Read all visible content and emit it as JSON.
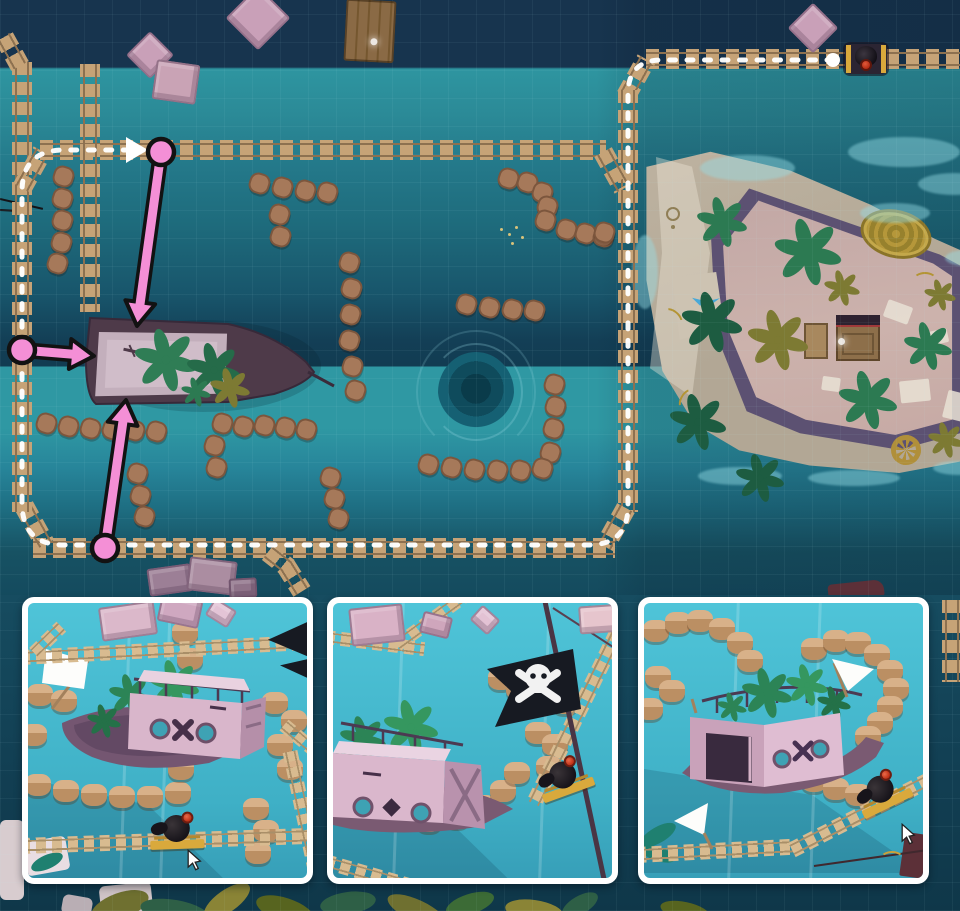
{
  "palette": {
    "backdrop": "#123f53",
    "waterLight": "#2f98a3",
    "stone": "#a6795a",
    "tieTan": "#c6a377",
    "railBrown": "#8d7150",
    "tieLight": "#d8bb90",
    "railLight": "#a98f68",
    "pillarTop": "#d8b189",
    "pillarSide": "#bb8f63",
    "insetWater1": "#4fc4d8",
    "insetWater2": "#3fb0c6",
    "cartGold": "#d9a93c",
    "pinkArrow": "#f48fd6",
    "arrowOutline": "#121212",
    "routeWhite": "#ffffff",
    "flagBlack": "#171a22",
    "shipHull": "#4e3a49",
    "insetHull": "#7a5a72",
    "porthole": "#3ea2b4"
  },
  "map": {
    "stone_dots": [
      [
        63,
        176
      ],
      [
        62,
        198
      ],
      [
        62,
        220
      ],
      [
        61,
        242
      ],
      [
        57,
        263
      ],
      [
        46,
        423
      ],
      [
        68,
        426
      ],
      [
        90,
        428
      ],
      [
        112,
        429
      ],
      [
        134,
        430
      ],
      [
        156,
        431
      ],
      [
        222,
        423
      ],
      [
        243,
        426
      ],
      [
        264,
        425
      ],
      [
        285,
        427
      ],
      [
        306,
        429
      ],
      [
        214,
        445
      ],
      [
        216,
        467
      ],
      [
        137,
        473
      ],
      [
        140,
        495
      ],
      [
        144,
        516
      ],
      [
        330,
        477
      ],
      [
        334,
        498
      ],
      [
        338,
        518
      ],
      [
        349,
        262
      ],
      [
        351,
        288
      ],
      [
        350,
        314
      ],
      [
        349,
        340
      ],
      [
        352,
        366
      ],
      [
        355,
        390
      ],
      [
        259,
        183
      ],
      [
        282,
        187
      ],
      [
        305,
        190
      ],
      [
        327,
        192
      ],
      [
        279,
        214
      ],
      [
        280,
        236
      ],
      [
        508,
        178
      ],
      [
        527,
        182
      ],
      [
        542,
        192
      ],
      [
        547,
        206
      ],
      [
        545,
        220
      ],
      [
        566,
        229
      ],
      [
        585,
        233
      ],
      [
        603,
        236
      ],
      [
        466,
        304
      ],
      [
        489,
        307
      ],
      [
        512,
        309
      ],
      [
        534,
        310
      ],
      [
        554,
        384
      ],
      [
        555,
        406
      ],
      [
        553,
        428
      ],
      [
        550,
        452
      ],
      [
        542,
        468
      ],
      [
        520,
        470
      ],
      [
        497,
        470
      ],
      [
        474,
        469
      ],
      [
        451,
        467
      ],
      [
        428,
        464
      ],
      [
        259,
        346
      ],
      [
        281,
        355
      ],
      [
        604,
        232
      ]
    ],
    "tracks": [
      {
        "x": 646,
        "y": 59,
        "len": 314,
        "a": 0
      },
      {
        "x": 626,
        "y": 96,
        "len": 42,
        "a": -61
      },
      {
        "x": 628,
        "y": 90,
        "len": 422,
        "a": 90
      },
      {
        "x": 626,
        "y": 508,
        "len": 44,
        "a": 119
      },
      {
        "x": 33,
        "y": 548,
        "len": 582,
        "a": 0
      },
      {
        "x": 24,
        "y": 506,
        "len": 44,
        "a": 61
      },
      {
        "x": 22,
        "y": 62,
        "len": 450,
        "a": 90
      },
      {
        "x": 22,
        "y": 188,
        "len": 42,
        "a": -61
      },
      {
        "x": 40,
        "y": 150,
        "len": 566,
        "a": 0
      },
      {
        "x": 603,
        "y": 152,
        "len": 42,
        "a": 61
      },
      {
        "x": 20,
        "y": 66,
        "len": 34,
        "a": -119
      },
      {
        "x": 90,
        "y": 64,
        "len": 248,
        "a": 90
      },
      {
        "x": 268,
        "y": 552,
        "len": 26,
        "a": 38
      },
      {
        "x": 286,
        "y": 566,
        "len": 30,
        "a": 58
      },
      {
        "x": 952,
        "y": 600,
        "len": 82,
        "a": 90
      }
    ],
    "crates": [
      {
        "x": 150,
        "y": 55,
        "w": 34,
        "h": 34,
        "a": 45,
        "c": "#c9a0b8",
        "n": "floating-crate-diamond"
      },
      {
        "x": 176,
        "y": 82,
        "w": 44,
        "h": 40,
        "a": 8,
        "c": "#c9a3b5",
        "n": "floating-crate-box"
      },
      {
        "x": 258,
        "y": 18,
        "w": 46,
        "h": 46,
        "a": 45,
        "c": "#c9a0b8",
        "n": "floating-crate-diamond"
      },
      {
        "x": 813,
        "y": 28,
        "w": 36,
        "h": 36,
        "a": 45,
        "c": "#c9a0b8",
        "n": "floating-crate-diamond"
      },
      {
        "x": 170,
        "y": 580,
        "w": 44,
        "h": 28,
        "a": -8,
        "c": "#9c7f96",
        "n": "sunken-crate"
      },
      {
        "x": 212,
        "y": 576,
        "w": 48,
        "h": 34,
        "a": 7,
        "c": "#ab8da1",
        "n": "sunken-crate"
      },
      {
        "x": 243,
        "y": 588,
        "w": 28,
        "h": 20,
        "a": -3,
        "c": "#8f7389",
        "n": "sunken-crate"
      }
    ],
    "plants": [
      {
        "x": 722,
        "y": 222,
        "r": 24,
        "c": "#2c7a52"
      },
      {
        "x": 808,
        "y": 252,
        "r": 32,
        "c": "#2c7a52"
      },
      {
        "x": 842,
        "y": 288,
        "r": 17,
        "c": "#7d7a33"
      },
      {
        "x": 712,
        "y": 322,
        "r": 29,
        "c": "#1d5c41"
      },
      {
        "x": 778,
        "y": 340,
        "r": 29,
        "c": "#7d7a33"
      },
      {
        "x": 928,
        "y": 346,
        "r": 23,
        "c": "#2c7a52"
      },
      {
        "x": 940,
        "y": 295,
        "r": 15,
        "c": "#7d7a33"
      },
      {
        "x": 698,
        "y": 422,
        "r": 27,
        "c": "#1d5c41"
      },
      {
        "x": 868,
        "y": 400,
        "r": 28,
        "c": "#2c7a52"
      },
      {
        "x": 760,
        "y": 478,
        "r": 23,
        "c": "#1d5c41"
      },
      {
        "x": 946,
        "y": 440,
        "r": 17,
        "c": "#7d7a33"
      }
    ],
    "specks": [
      [
        500,
        228
      ],
      [
        508,
        233
      ],
      [
        515,
        226
      ],
      [
        521,
        236
      ],
      [
        511,
        242
      ]
    ],
    "route": {
      "d": "M 833 60 L 662 60 Q 628 60 628 94 L 628 506 Q 628 545 588 545 L 64 545 Q 22 545 22 503 L 22 192 Q 22 150 64 150 L 130 150",
      "dash": "6 11.5",
      "width": 5,
      "start": [
        833,
        60
      ],
      "start_r": 7,
      "arrow": "148,150 126,137 126,163"
    },
    "arrows": [
      {
        "x1": 161,
        "y1": 152,
        "x2": 137,
        "y2": 326
      },
      {
        "x1": 22,
        "y1": 350,
        "x2": 94,
        "y2": 356
      },
      {
        "x1": 105,
        "y1": 548,
        "x2": 126,
        "y2": 400
      }
    ]
  },
  "insets": [
    {
      "x": 22,
      "pillars": [
        [
          12,
          92
        ],
        [
          36,
          98
        ],
        [
          6,
          132
        ],
        [
          247,
          100
        ],
        [
          266,
          118
        ],
        [
          252,
          142
        ],
        [
          157,
          30
        ],
        [
          162,
          56
        ],
        [
          10,
          182
        ],
        [
          38,
          188
        ],
        [
          66,
          192
        ],
        [
          94,
          194
        ],
        [
          122,
          194
        ],
        [
          150,
          190
        ],
        [
          153,
          166
        ],
        [
          228,
          206
        ],
        [
          238,
          228
        ],
        [
          230,
          250
        ],
        [
          262,
          166
        ]
      ],
      "tracks": [
        {
          "x": -8,
          "y": 54,
          "len": 300,
          "a": -3,
          "h": 15
        },
        {
          "x": 6,
          "y": 50,
          "len": 38,
          "a": -44,
          "h": 14
        },
        {
          "x": 262,
          "y": 148,
          "len": 145,
          "a": 78,
          "h": 15
        },
        {
          "x": 256,
          "y": 122,
          "len": 40,
          "a": 40,
          "h": 14
        },
        {
          "x": -8,
          "y": 243,
          "len": 300,
          "a": -2,
          "h": 16
        }
      ],
      "crates": [
        {
          "x": 100,
          "y": 18,
          "w": 56,
          "h": 34,
          "a": -8,
          "c": "#dbb8ca"
        },
        {
          "x": 152,
          "y": 8,
          "w": 42,
          "h": 28,
          "a": 12,
          "c": "#cfa8c0"
        },
        {
          "x": 193,
          "y": 10,
          "w": 26,
          "h": 20,
          "a": 32,
          "c": "#e3c4d6"
        }
      ],
      "cannon": {
        "x": 122,
        "y": 210,
        "a": -2
      },
      "cursor": {
        "x": 158,
        "y": 246
      },
      "rays": [
        96,
        136
      ]
    },
    {
      "x": 327,
      "pillars": [
        [
          168,
          76
        ],
        [
          186,
          86
        ],
        [
          205,
          130
        ],
        [
          222,
          142
        ],
        [
          216,
          164
        ],
        [
          14,
          192
        ],
        [
          40,
          206
        ],
        [
          68,
          214
        ],
        [
          96,
          218
        ],
        [
          124,
          214
        ],
        [
          150,
          203
        ],
        [
          170,
          188
        ],
        [
          184,
          170
        ],
        [
          232,
          100
        ]
      ],
      "tracks": [
        {
          "x": -8,
          "y": 34,
          "len": 100,
          "a": 7,
          "h": 14
        },
        {
          "x": 64,
          "y": 42,
          "len": 90,
          "a": -36,
          "h": 14
        },
        {
          "x": 284,
          "y": 30,
          "len": 190,
          "a": 116,
          "h": 16
        },
        {
          "x": -8,
          "y": 258,
          "len": 130,
          "a": 16,
          "h": 15
        }
      ],
      "crates": [
        {
          "x": 44,
          "y": 22,
          "w": 54,
          "h": 38,
          "a": -6,
          "c": "#d9b2c6"
        },
        {
          "x": 103,
          "y": 22,
          "w": 30,
          "h": 22,
          "a": 14,
          "c": "#cfa6bc"
        },
        {
          "x": 152,
          "y": 17,
          "w": 24,
          "h": 20,
          "a": 42,
          "c": "#e3c2d4"
        },
        {
          "x": 268,
          "y": 16,
          "w": 44,
          "h": 28,
          "a": -4,
          "c": "#e6c5cd"
        }
      ],
      "cannon": {
        "x": 205,
        "y": 156,
        "a": -20
      },
      "cursor": null,
      "rays": [
        64,
        210
      ]
    },
    {
      "x": 638,
      "pillars": [
        [
          12,
          28
        ],
        [
          34,
          20
        ],
        [
          56,
          18
        ],
        [
          78,
          26
        ],
        [
          96,
          40
        ],
        [
          106,
          58
        ],
        [
          170,
          46
        ],
        [
          192,
          38
        ],
        [
          214,
          40
        ],
        [
          233,
          52
        ],
        [
          246,
          68
        ],
        [
          252,
          86
        ],
        [
          246,
          104
        ],
        [
          236,
          120
        ],
        [
          224,
          134
        ],
        [
          14,
          74
        ],
        [
          28,
          88
        ],
        [
          148,
          168
        ],
        [
          170,
          178
        ],
        [
          192,
          186
        ],
        [
          214,
          192
        ],
        [
          6,
          106
        ]
      ],
      "tracks": [
        {
          "x": -8,
          "y": 252,
          "len": 160,
          "a": -3,
          "h": 16
        },
        {
          "x": 148,
          "y": 247,
          "len": 180,
          "a": -27,
          "h": 16
        }
      ],
      "crates": [],
      "cannon": {
        "x": 212,
        "y": 170,
        "a": -26
      },
      "cursor": {
        "x": 256,
        "y": 220
      },
      "rays": [
        88,
        170
      ]
    }
  ],
  "backdrop": {
    "leaves": [
      [
        90,
        893,
        60,
        26,
        -20,
        "#6f7030"
      ],
      [
        140,
        900,
        70,
        24,
        10,
        "#2e5f46"
      ],
      [
        200,
        890,
        54,
        22,
        -35,
        "#8a8436"
      ],
      [
        255,
        898,
        60,
        24,
        18,
        "#57641f"
      ],
      [
        320,
        892,
        56,
        22,
        -8,
        "#2e5f46"
      ],
      [
        385,
        900,
        64,
        22,
        25,
        "#6f7030"
      ],
      [
        445,
        894,
        50,
        20,
        -18,
        "#3c6b36"
      ],
      [
        505,
        900,
        58,
        22,
        8,
        "#8a8436"
      ],
      [
        560,
        896,
        40,
        18,
        -30,
        "#2e5f46"
      ],
      [
        660,
        902,
        50,
        18,
        12,
        "#57641f"
      ]
    ],
    "rocks": [
      [
        100,
        884,
        52,
        30,
        -6,
        "#cfc3c6"
      ],
      [
        0,
        820,
        24,
        80,
        0,
        "#d8cccf"
      ],
      [
        62,
        896,
        30,
        20,
        10,
        "#b9aeb4"
      ]
    ]
  },
  "island_papers": [
    [
      245,
      208,
      26,
      18,
      20
    ],
    [
      288,
      235,
      20,
      14,
      -12
    ],
    [
      182,
      282,
      18,
      14,
      8
    ],
    [
      260,
      285,
      30,
      22,
      -6
    ],
    [
      305,
      297,
      22,
      28,
      14
    ]
  ],
  "island_shallows": [
    [
      60,
      60,
      95,
      26
    ],
    [
      220,
      108,
      70,
      20
    ],
    [
      305,
      155,
      42,
      16
    ],
    [
      -8,
      140,
      26,
      74
    ],
    [
      58,
      372,
      84,
      18
    ],
    [
      168,
      375,
      92,
      16
    ],
    [
      293,
      366,
      52,
      14
    ],
    [
      208,
      42,
      112,
      30
    ],
    [
      278,
      78,
      72,
      22
    ]
  ]
}
